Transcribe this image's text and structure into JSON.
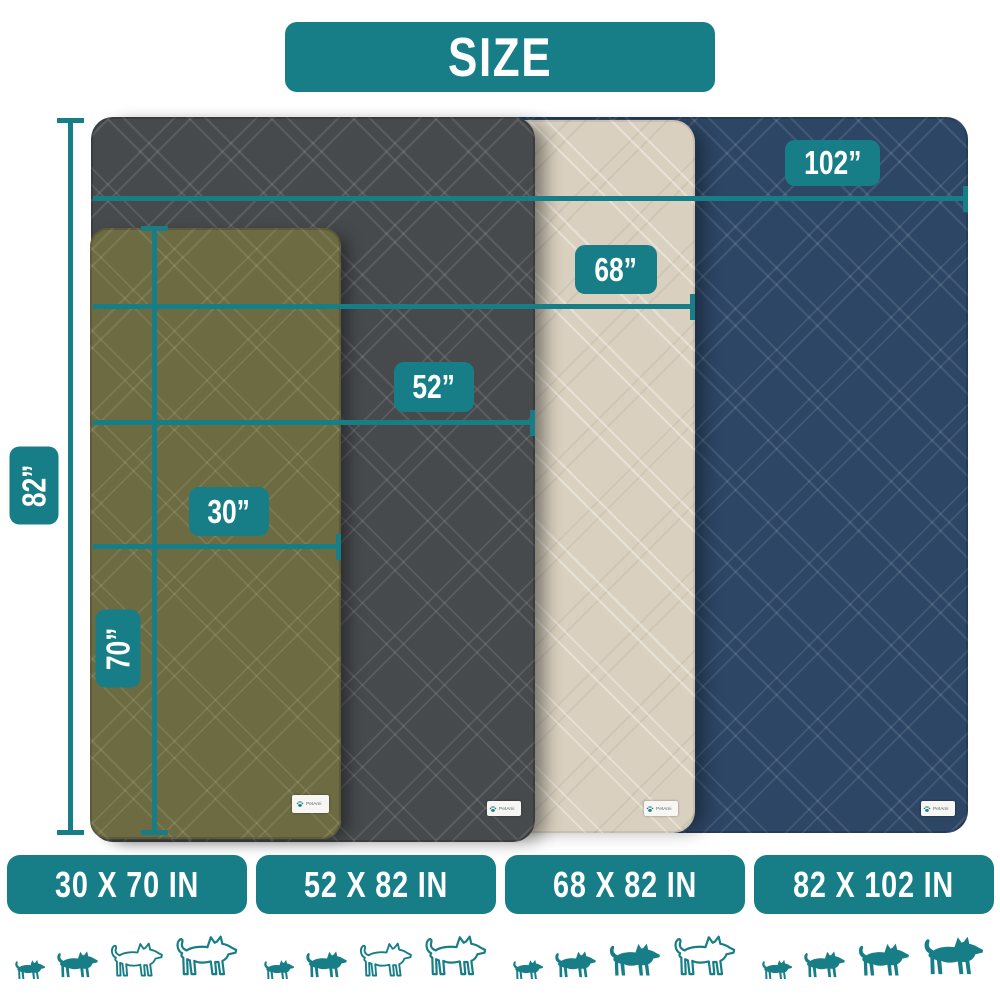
{
  "header": {
    "title": "SIZE"
  },
  "brand": {
    "tag": "PetAmi"
  },
  "colors": {
    "teal_accent": "#177e87",
    "olive_blanket": "#6d6b41",
    "gray_blanket": "#474a4d",
    "beige_blanket": "#d9d0bf",
    "navy_blanket": "#2d4666",
    "white_text": "#ffffff"
  },
  "measurements": {
    "m102": {
      "label": "102”"
    },
    "m68": {
      "label": "68”"
    },
    "m52": {
      "label": "52”"
    },
    "m30": {
      "label": "30”"
    },
    "m82": {
      "label": "82”"
    },
    "m70": {
      "label": "70”"
    }
  },
  "blankets": [
    {
      "name": "olive-green",
      "size": "30 x 70 in"
    },
    {
      "name": "dark-gray",
      "size": "52 x 82 in"
    },
    {
      "name": "beige",
      "size": "68 x 82 in"
    },
    {
      "name": "navy-blue",
      "size": "82 x 102 in"
    }
  ],
  "size_bars": [
    {
      "label": "30 X 70 IN",
      "dogs_filled": 2,
      "dogs_total": 4
    },
    {
      "label": "52 X 82 IN",
      "dogs_filled": 2,
      "dogs_total": 4
    },
    {
      "label": "68 X 82 IN",
      "dogs_filled": 3,
      "dogs_total": 4
    },
    {
      "label": "82 X 102 IN",
      "dogs_filled": 4,
      "dogs_total": 4
    }
  ],
  "dog_icon_heights": [
    28,
    38,
    47,
    55
  ]
}
